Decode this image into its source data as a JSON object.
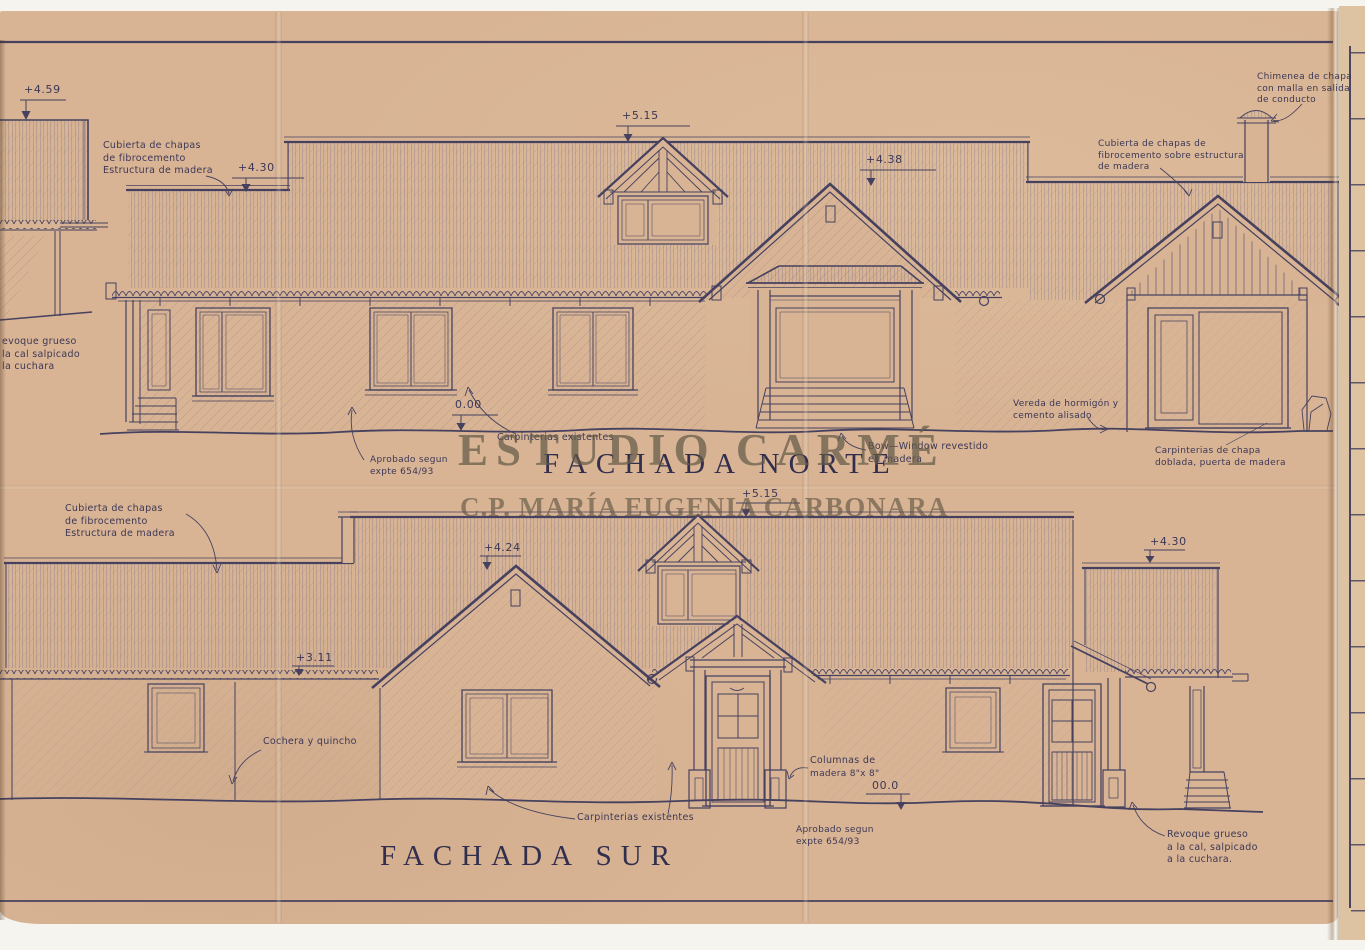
{
  "colors": {
    "paper": "#d8b494",
    "ink": "#46415f",
    "watermark": "#685e4c"
  },
  "watermark": {
    "studio": "ESTUDIO CARMÉ",
    "architect": "C.P. MARÍA EUGENIA CARBONARA"
  },
  "north": {
    "title": "FACHADA NORTE",
    "dims": {
      "left_annex": "+4.59",
      "left_roof": "+4.30",
      "ridge": "+5.15",
      "gable": "+4.38",
      "ground": "0.00"
    },
    "notes": {
      "roof_left": [
        "Cubierta de chapas",
        "de fibrocemento",
        "Estructura de madera"
      ],
      "render_left": [
        "evoque grueso",
        "la cal salpicado",
        "la cuchara"
      ],
      "chimney": [
        "Chimenea de chapa",
        "con malla en salida",
        "de conducto"
      ],
      "roof_right": [
        "Cubierta de chapas de",
        "fibrocemento sobre estructura",
        "de madera"
      ],
      "approved": [
        "Aprobado segun",
        "expte 654/93"
      ],
      "joinery": "Carpinterias existentes",
      "bow_window": [
        "Bow—Window revestido",
        "en madera"
      ],
      "sidewalk": [
        "Vereda de hormigón y",
        "cemento alisado"
      ],
      "sheet_joinery": [
        "Carpinterias de chapa",
        "doblada, puerta de madera"
      ]
    }
  },
  "south": {
    "title": "FACHADA SUR",
    "dims": {
      "dormer": "+5.15",
      "gable": "+4.24",
      "eave": "+3.11",
      "right_roof": "+4.30",
      "ground": "00.0"
    },
    "notes": {
      "roof_left": [
        "Cubierta de chapas",
        "de fibrocemento",
        "Estructura de madera"
      ],
      "garage": "Cochera y quincho",
      "joinery": "Carpinterias existentes",
      "columns": [
        "Columnas de",
        "madera 8\"x 8\""
      ],
      "approved": [
        "Aprobado segun",
        "expte 654/93"
      ],
      "render": [
        "Revoque grueso",
        "a la cal, salpicado",
        "a la cuchara."
      ]
    }
  }
}
